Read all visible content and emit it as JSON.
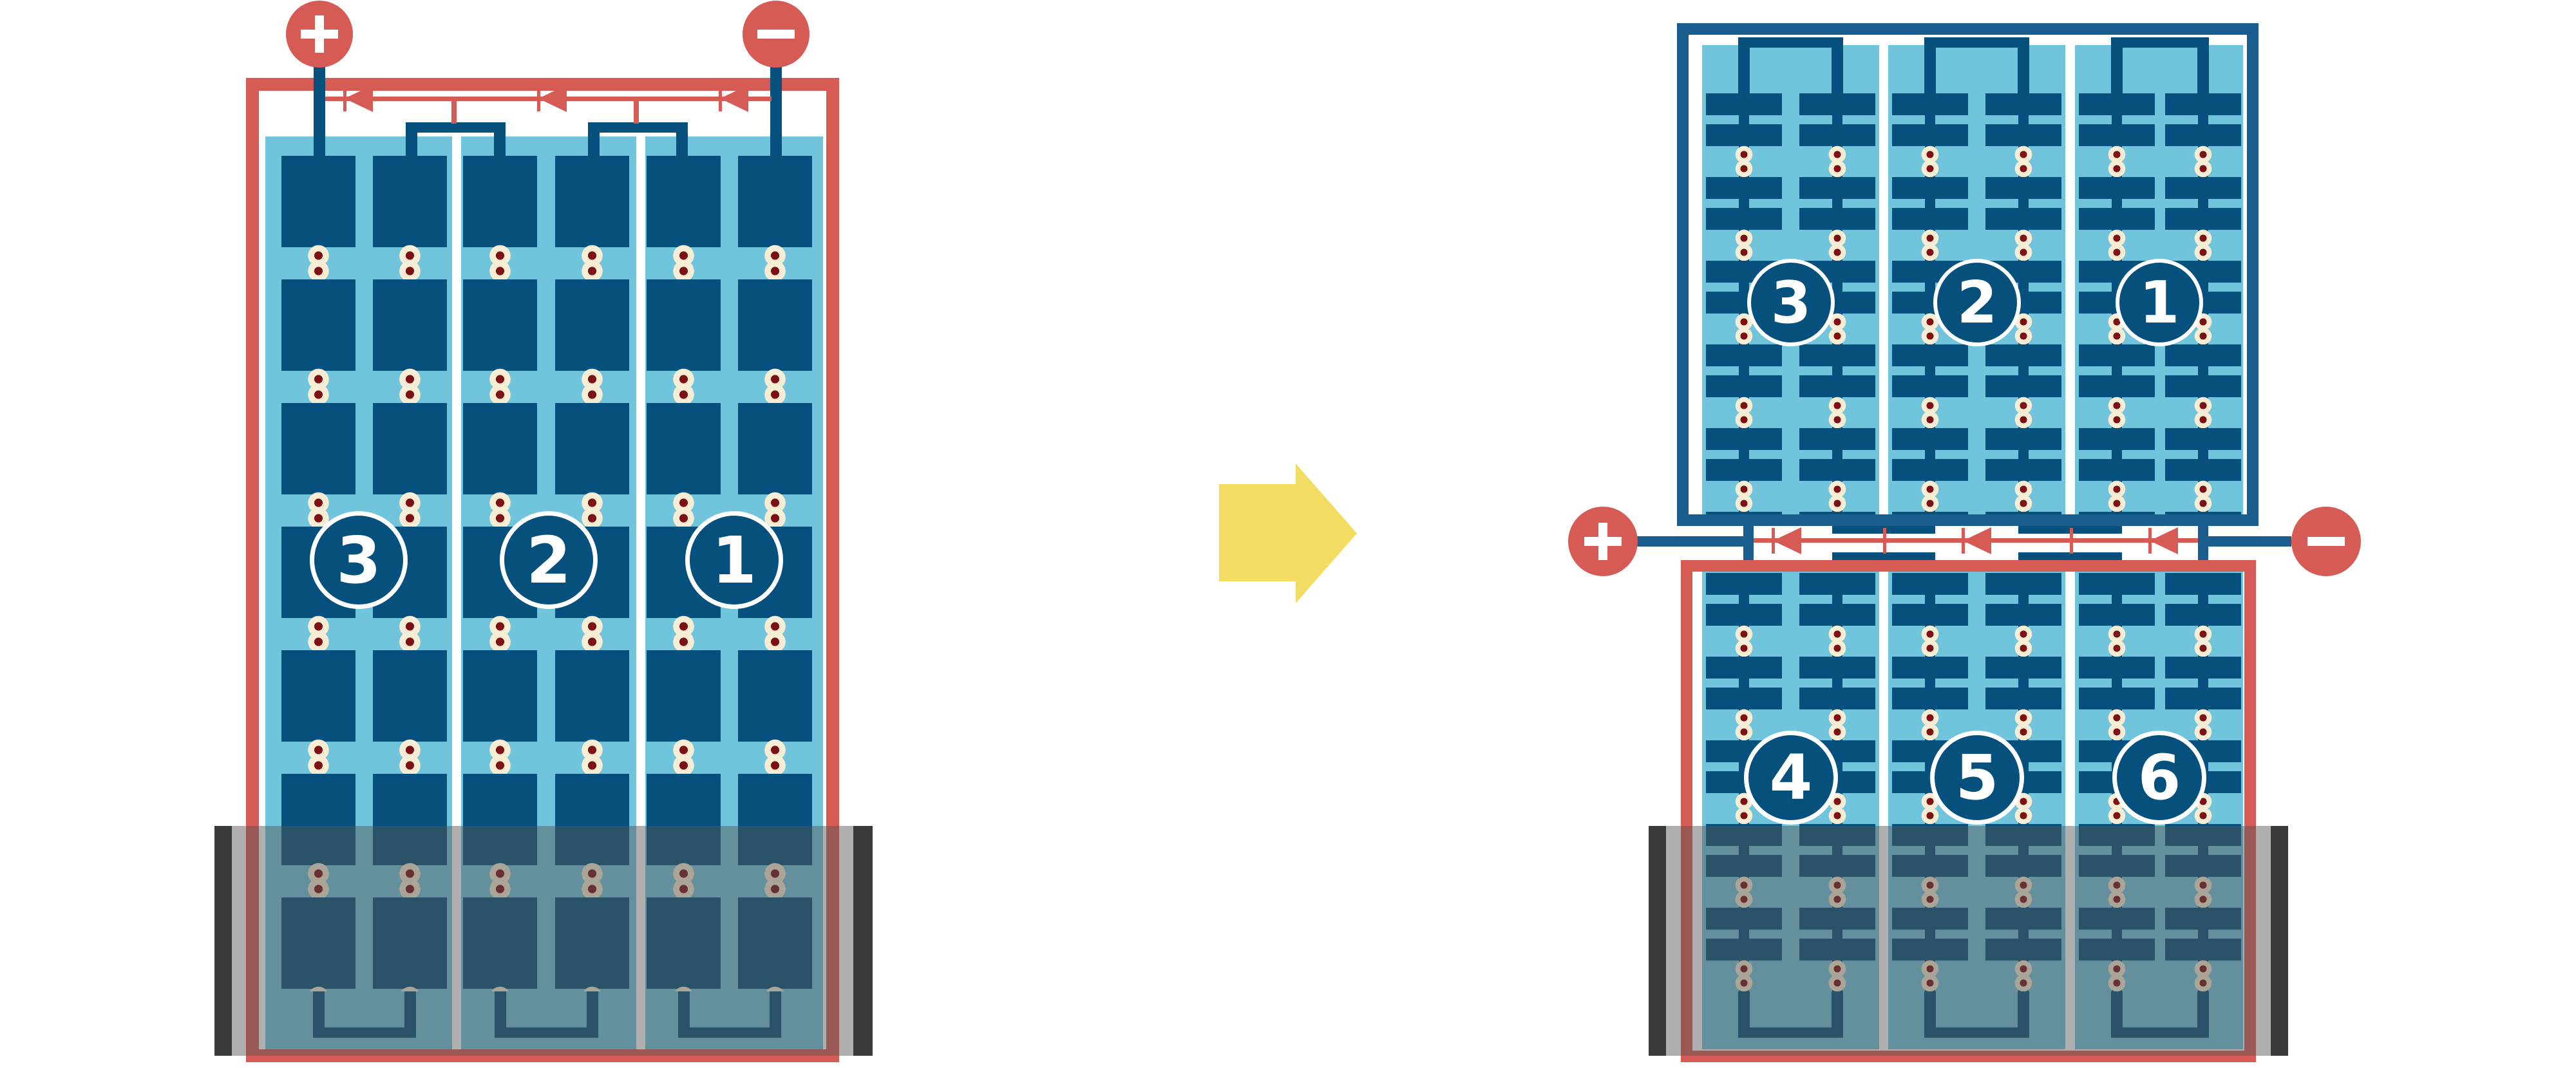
{
  "title": "battery-series-cells-reconfiguration-diagram",
  "left_battery": {
    "description": "single battery, three cells in series, terminals on top",
    "cells": [
      {
        "label": "3"
      },
      {
        "label": "2"
      },
      {
        "label": "1"
      }
    ],
    "terminals": {
      "positive": {
        "icon": "plus-icon",
        "symbol": "+"
      },
      "negative": {
        "icon": "minus-icon",
        "symbol": "−"
      }
    },
    "current_arrows": {
      "count": 3,
      "direction": "left",
      "icon": "current-arrowhead-icon"
    }
  },
  "transform_arrow": {
    "icon": "right-arrow-icon",
    "color": "#F2DD62"
  },
  "right_battery": {
    "description": "battery split into two stacked modules with terminals in the middle",
    "top_module": {
      "cells": [
        {
          "label": "3"
        },
        {
          "label": "2"
        },
        {
          "label": "1"
        }
      ]
    },
    "bottom_module": {
      "cells": [
        {
          "label": "4"
        },
        {
          "label": "5"
        },
        {
          "label": "6"
        }
      ]
    },
    "terminals": {
      "positive": {
        "icon": "plus-icon",
        "symbol": "+"
      },
      "negative": {
        "icon": "minus-icon",
        "symbol": "−"
      }
    },
    "current_arrows": {
      "count": 3,
      "direction": "left",
      "icon": "current-arrowhead-icon"
    }
  },
  "colors": {
    "circuit_red": "#D55B54",
    "plate_blue": "#05507C",
    "module_frame_blue": "#1A5E90",
    "electrolyte_light_blue": "#70C4DC",
    "transform_arrow_yellow": "#F2DD62",
    "rivet_dot_outer": "#F7ECD4",
    "rivet_dot_inner": "#7E1114",
    "case_gray": "#3B3B3B"
  }
}
